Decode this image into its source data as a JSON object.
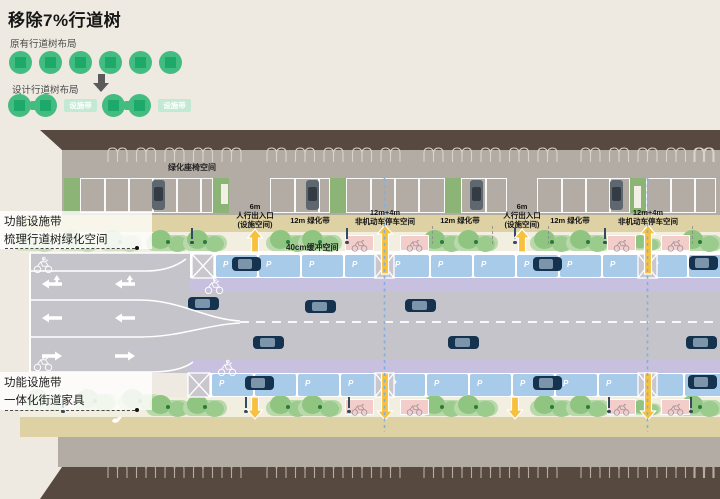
{
  "title": "移除7%行道树",
  "legend": {
    "original_label": "原有行道树布局",
    "designed_label": "设计行道树布局",
    "facility_belt": "设施带",
    "colors": {
      "tree": "#42bc80",
      "tree_square": "#1ea96a",
      "pill_bg": "#c2e9d4"
    }
  },
  "plan": {
    "setback_label": "绿化座椅空间",
    "buffer_label": "40cm缓冲空间",
    "callouts": [
      {
        "line1": "功能设施带",
        "line2": "梳理行道树绿化空间"
      },
      {
        "line1": "功能设施带",
        "line2": "一体化街道家具"
      }
    ],
    "dim_labels": [
      {
        "lines": [
          "6m",
          "人行出入口",
          "(设施空间)"
        ]
      },
      {
        "lines": [
          "12m 绿化带"
        ]
      },
      {
        "lines": [
          "12m+4m",
          "非机动车停车空间"
        ]
      },
      {
        "lines": [
          "12m 绿化带"
        ]
      },
      {
        "lines": [
          "6m",
          "人行出入口",
          "(设施空间)"
        ]
      },
      {
        "lines": [
          "12m 绿化带"
        ]
      },
      {
        "lines": [
          "12m+4m",
          "非机动车停车空间"
        ]
      }
    ],
    "colors": {
      "building": "#57493f",
      "setback": "#b3aca4",
      "sidewalk": "#ded2a4",
      "green_band": "#f2eee0",
      "tree": "#9ccb8e",
      "bike_parking": "#f3cdca",
      "car_parking": "#a9cbea",
      "bike_lane": "#c7c0de",
      "road": "#c6c4cb",
      "arrow_yellow": "#f7c13d",
      "car": "#15334f",
      "section_line": "#85aede",
      "marking_white": "#ffffff"
    }
  }
}
